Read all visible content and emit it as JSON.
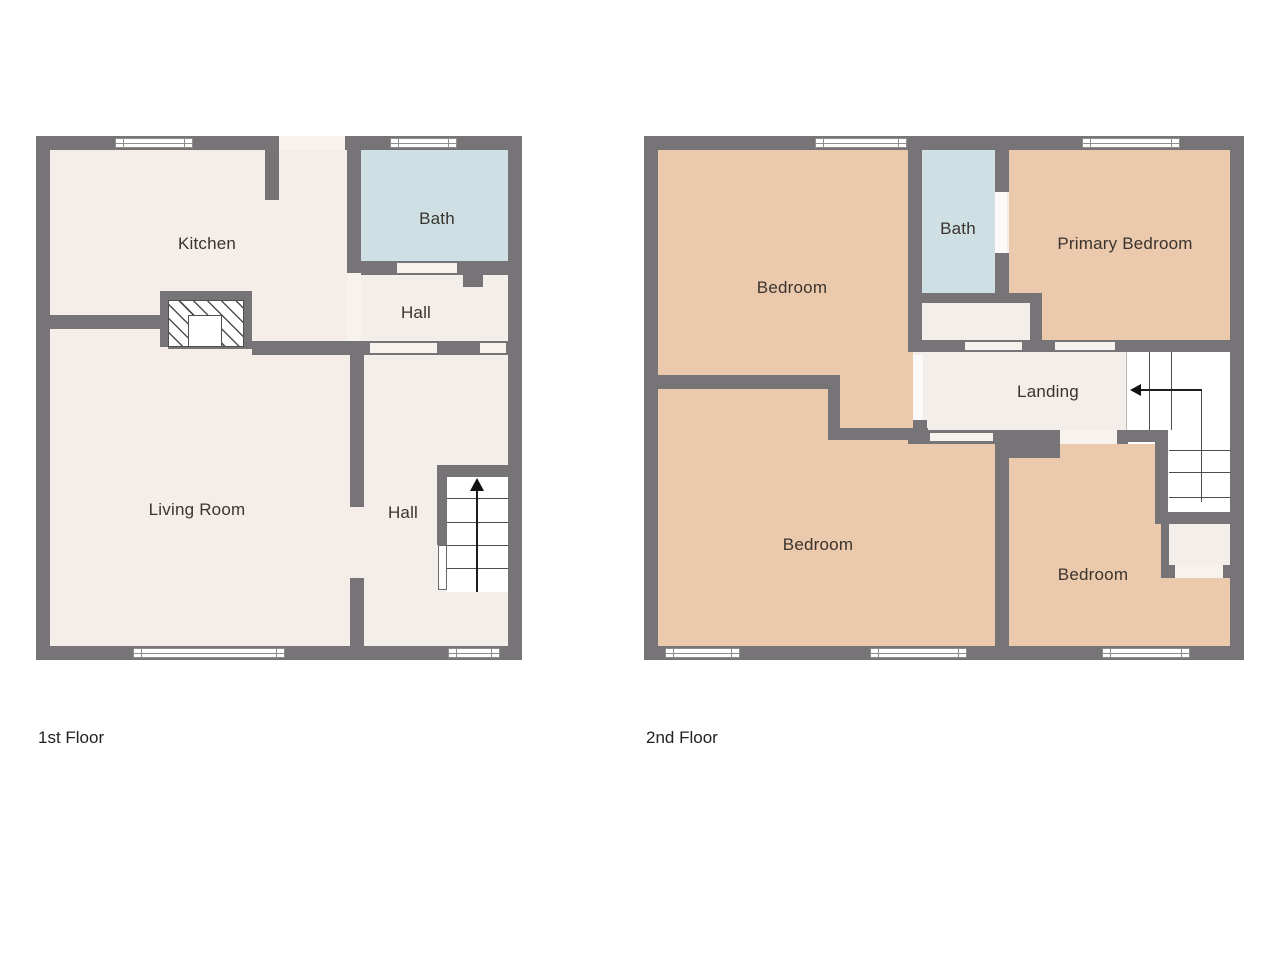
{
  "floor1": {
    "caption": "1st Floor",
    "rooms": {
      "kitchen": "Kitchen",
      "bath": "Bath",
      "hall_upper": "Hall",
      "living_room": "Living Room",
      "hall_lower": "Hall"
    }
  },
  "floor2": {
    "caption": "2nd Floor",
    "rooms": {
      "bedroom_top_left": "Bedroom",
      "bath": "Bath",
      "primary_bedroom": "Primary Bedroom",
      "landing": "Landing",
      "bedroom_bottom_left": "Bedroom",
      "bedroom_bottom_right": "Bedroom"
    }
  },
  "icons": {
    "floor1_stair_arrow": "arrow-up",
    "floor2_stair_arrow": "arrow-left"
  },
  "colors": {
    "wall": "#767476",
    "room_floor": "#F5EEE8",
    "hall_floor": "#F3EEE9",
    "bath_floor": "#CEE0E3",
    "bedroom_floor": "#EBC9AD",
    "stairs": "#FFFFFF",
    "door_opening": "#F7F2EC",
    "text": "#3A332E",
    "background": "#FFFFFF"
  }
}
